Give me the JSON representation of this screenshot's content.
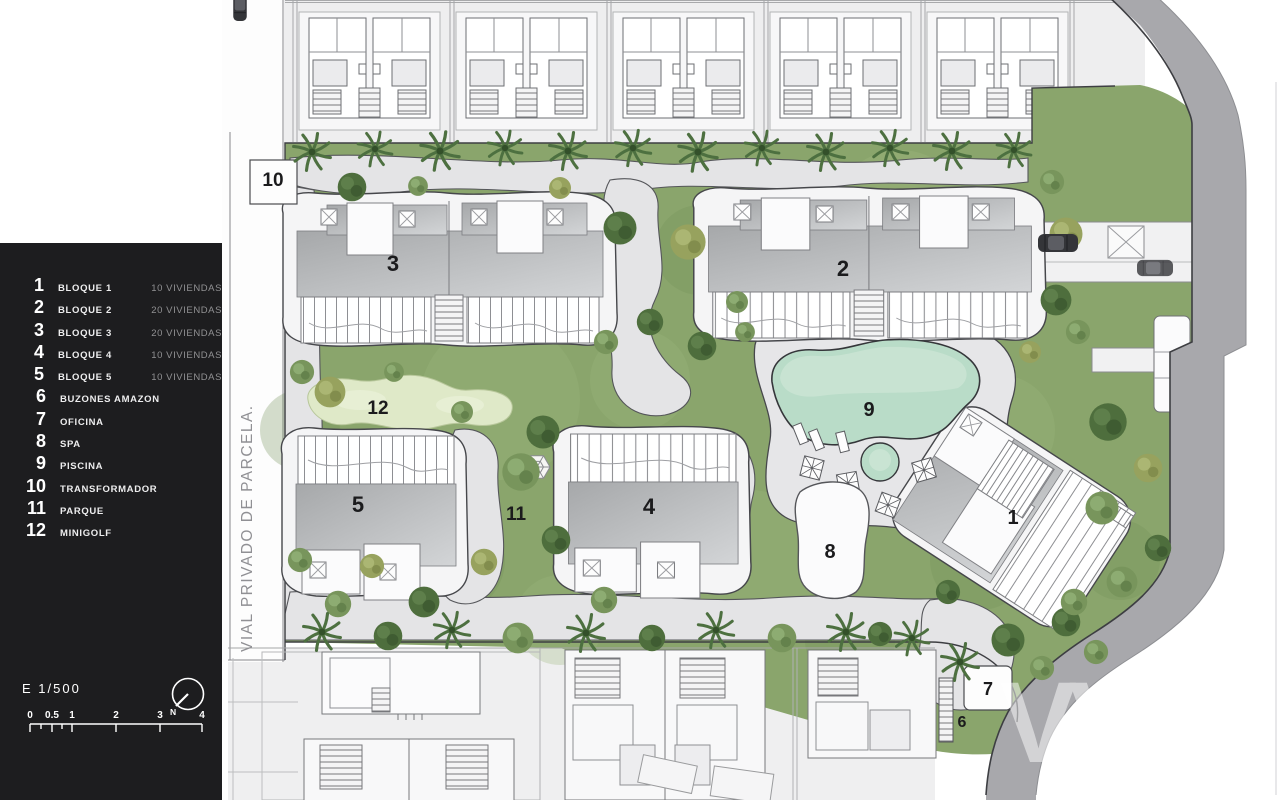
{
  "legend": {
    "items": [
      {
        "num": "1",
        "label": "BLOQUE 1",
        "detail": "10 VIVIENDAS"
      },
      {
        "num": "2",
        "label": "BLOQUE 2",
        "detail": "20 VIVIENDAS"
      },
      {
        "num": "3",
        "label": "BLOQUE 3",
        "detail": "20 VIVIENDAS"
      },
      {
        "num": "4",
        "label": "BLOQUE 4",
        "detail": "10 VIVIENDAS"
      },
      {
        "num": "5",
        "label": "BLOQUE 5",
        "detail": "10 VIVIENDAS"
      },
      {
        "num": "6",
        "label": "BUZONES AMAZON",
        "detail": ""
      },
      {
        "num": "7",
        "label": "OFICINA",
        "detail": ""
      },
      {
        "num": "8",
        "label": "SPA",
        "detail": ""
      },
      {
        "num": "9",
        "label": "PISCINA",
        "detail": ""
      },
      {
        "num": "10",
        "label": "TRANSFORMADOR",
        "detail": ""
      },
      {
        "num": "11",
        "label": "PARQUE",
        "detail": ""
      },
      {
        "num": "12",
        "label": "MINIGOLF",
        "detail": ""
      }
    ]
  },
  "scale": {
    "label": "E 1/500",
    "ticks": [
      "0",
      "0.5",
      "1",
      "2",
      "3",
      "4"
    ],
    "north": "N"
  },
  "plan": {
    "road_label": "VIAL PRIVADO DE PARCELA.",
    "watermark": "VV",
    "labels": {
      "b1": "1",
      "b2": "2",
      "b3": "3",
      "b4": "4",
      "b5": "5",
      "b6": "6",
      "b7": "7",
      "b8": "8",
      "b9": "9",
      "b10": "10",
      "b11": "11",
      "b12": "12"
    }
  },
  "colors": {
    "panel": "#1d1d1f",
    "grass": "#8aa56c",
    "pool": "#b9dcc8",
    "roof": "#b4b6b8",
    "road": "#a8a8ac",
    "path": "#e4e4e6"
  }
}
